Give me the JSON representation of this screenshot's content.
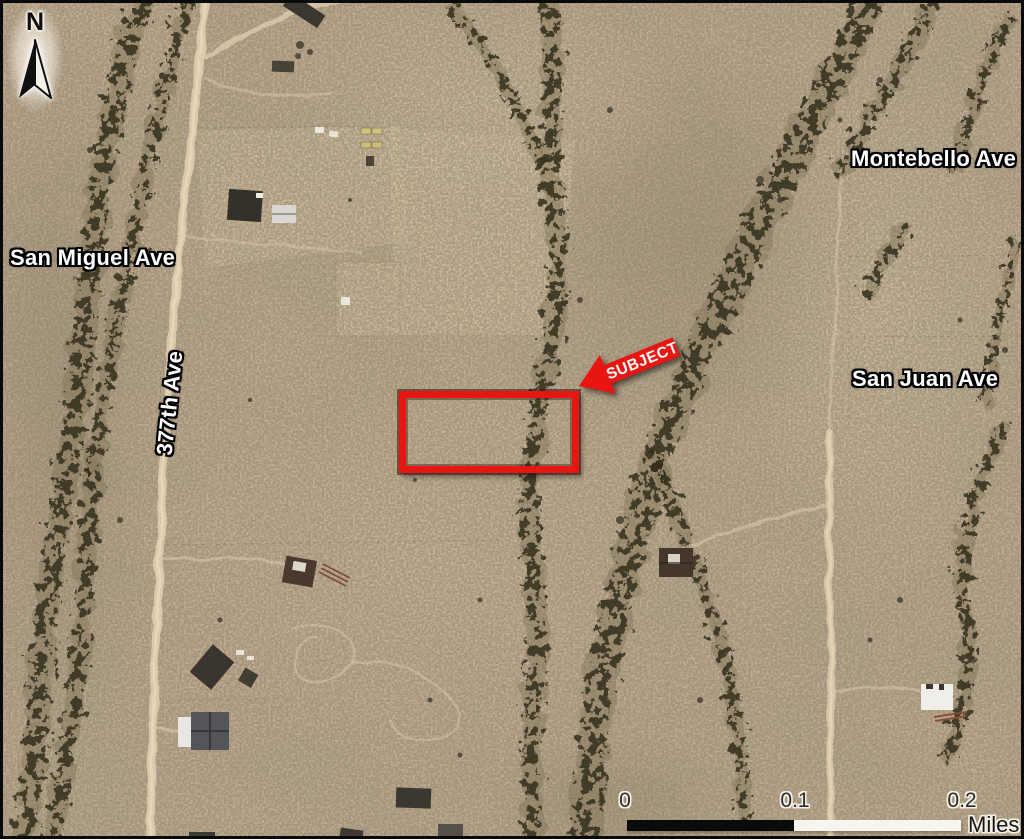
{
  "map": {
    "north": {
      "label": "N"
    },
    "streets": {
      "san_miguel": "San Miguel Ave",
      "montebello": "Montebello Ave",
      "ave377": "377th Ave",
      "san_juan": "San Juan Ave"
    },
    "subject": {
      "label": "SUBJECT"
    },
    "scalebar": {
      "ticks": [
        "0",
        "0.1",
        "0.2"
      ],
      "unit": "Miles"
    },
    "colors": {
      "subject_red": "#e81510",
      "street_text": "#ffffff",
      "street_outline": "#000000",
      "scale_text": "#2b2b2b",
      "scalebar_black": "#0b0b0b",
      "scalebar_white": "#f7f5ef"
    }
  }
}
